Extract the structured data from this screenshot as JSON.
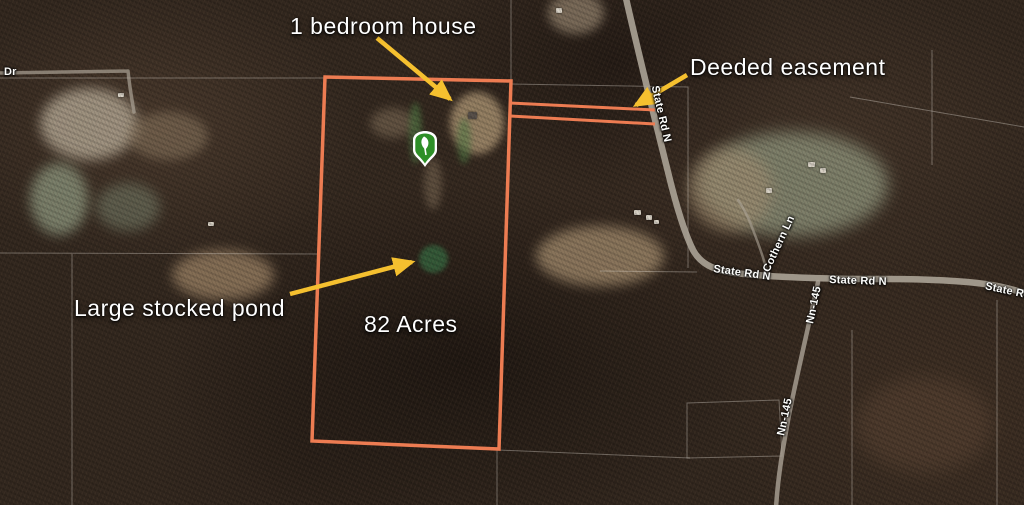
{
  "annotations": {
    "house_label": "1 bedroom house",
    "easement_label": "Deeded easement",
    "pond_label": "Large stocked pond",
    "acreage_label": "82 Acres"
  },
  "road_labels": {
    "dr": "Dr",
    "state_rd_n_vertical": "State Rd N",
    "state_rd_n_west": "State Rd N",
    "state_rd_n_east": "State Rd N",
    "state_rd_edge": "State Rd",
    "cothern_ln": "Cothern Ln",
    "nn_145_upper": "Nn-145",
    "nn_145_lower": "Nn-145"
  },
  "marker": {
    "icon": "tree-shield-pin"
  },
  "colors": {
    "parcel": "#ED7C52",
    "arrow": "#F5C02F",
    "marker": "#2E8F27",
    "label": "#FFFFFF",
    "road": "#ABA396"
  }
}
